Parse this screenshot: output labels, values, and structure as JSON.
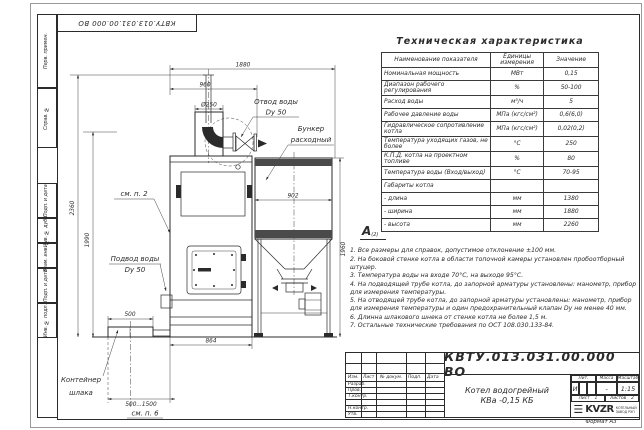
{
  "colors": {
    "ink": "#2b2b2b",
    "band": "#4a4a4a",
    "paper": "#ffffff"
  },
  "stamp_top": "КВТУ.013.031.00.000 ВО",
  "frame_labels": [
    "Перв. примен.",
    "Справ. №",
    "Подп. и дата",
    "Инв. № дубл.",
    "Взам. инв. №",
    "Подп. и дата",
    "Инв. № подл."
  ],
  "drawing": {
    "labels": {
      "otvod1": "Отвод воды",
      "otvod2": "Dy 50",
      "bunker1": "Бункер",
      "bunker2": "расходный",
      "smp2": "см. п. 2",
      "podvod1": "Подвод воды",
      "podvod2": "Dy 50",
      "cont1": "Контейнер",
      "cont2": "шлака",
      "smp6": "см. п. 6"
    },
    "dims": {
      "w1880": "1880",
      "w960": "960",
      "dia": "Ø250",
      "w902": "902",
      "h2360": "2360",
      "h1990": "1990",
      "h1960": "1960",
      "w500": "500",
      "w864": "864",
      "range": "500...1500"
    }
  },
  "tech": {
    "title": "Техническая характеристика",
    "headers": [
      "Наименование показателя",
      "Единицы измерения",
      "Значение"
    ],
    "rows": [
      [
        "Номинальная мощность",
        "МВт",
        "0,15"
      ],
      [
        "Диапазон рабочего регулирования",
        "%",
        "50-100"
      ],
      [
        "Расход воды",
        "м³/ч",
        "5"
      ],
      [
        "Рабочее давление воды",
        "МПа (кгс/см²)",
        "0,6(6,0)"
      ],
      [
        "Гидравлическое сопротивление котла",
        "МПа (кгс/см²)",
        "0,02(0,2)"
      ],
      [
        "Температура уходящих газов, не более",
        "°С",
        "250"
      ],
      [
        "К.П.Д. котла на проектном топливе",
        "%",
        "80"
      ],
      [
        "Температура воды (Вход/выход)",
        "°С",
        "70-95"
      ],
      [
        "Габариты котла",
        "",
        ""
      ],
      [
        "- длина",
        "мм",
        "1380"
      ],
      [
        "- ширина",
        "мм",
        "1880"
      ],
      [
        "- высота",
        "мм",
        "2260"
      ]
    ]
  },
  "view_mark": "А",
  "view_mark_sub": "(2)",
  "notes": [
    "1.  Все размеры для справок, допустимое отклонение ±100 мм.",
    "2.  На боковой стенке котла в области топочной камеры установлен пробоотборный штуцер.",
    "3.  Температура воды на входе 70°С, на выходе 95°С.",
    "4.  На подводящей трубе котла, до запорной арматуры установлены: манометр, прибор для измерения температуры.",
    "5.  На отводящей трубе котла, до запорной арматуры установлены: манометр, прибор для измерения температуры и один предохранительный клапан Dy не менее 40 мм.",
    "6.  Длинна шлакового шнека от стенке котла не более 1,5 м.",
    "7.  Остальные технические требования по ОСТ 108.030.133-84."
  ],
  "title_block": {
    "doc_number": "КВТУ.013.031.00.000 ВО",
    "name_line1": "Котел водогрейный",
    "name_line2": "КВа -0,15  КБ",
    "header_cols": [
      "Изм.",
      "Лист",
      "№ докум.",
      "Подп.",
      "Дата"
    ],
    "rows": [
      "Разраб.",
      "Пров.",
      "Т.контр.",
      "",
      "Н.контр.",
      "Утв."
    ],
    "lit_label": "Лит.",
    "lit_value": "И",
    "mass_label": "Масса",
    "mass_value": "-",
    "scale_label": "Масштаб",
    "scale_value": "1:15",
    "sheet_label": "Лист",
    "sheet_value": "1",
    "sheets_label": "Листов",
    "sheets_value": "2",
    "logo_icon": "☰",
    "logo_text": "KVZR",
    "logo_tag1": "КОТЕЛЬНЫЙ",
    "logo_tag2": "ЗАВОД РЭП",
    "format": "Формат А3"
  }
}
